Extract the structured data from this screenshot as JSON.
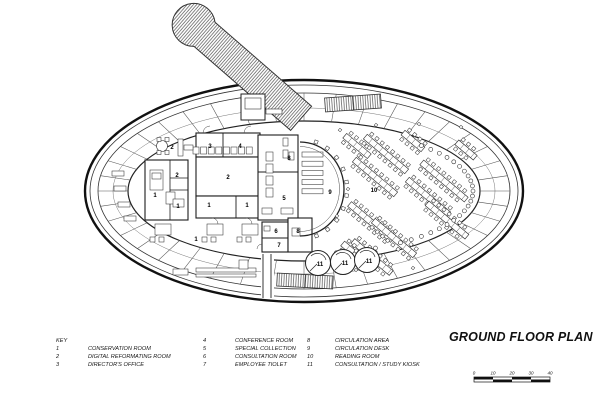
{
  "title": "GROUND FLOOR PLAN",
  "key": {
    "heading": "KEY",
    "items": [
      {
        "num": "1",
        "label": "CONSERVATION ROOM"
      },
      {
        "num": "2",
        "label": "DIGITAL REFORMATING ROOM"
      },
      {
        "num": "3",
        "label": "DIRECTOR'S OFFICE"
      },
      {
        "num": "4",
        "label": "CONFERENCE ROOM"
      },
      {
        "num": "5",
        "label": "SPECIAL COLLECTION"
      },
      {
        "num": "6",
        "label": "CONSULTATION ROOM"
      },
      {
        "num": "7",
        "label": "EMPLOYEE TIOLET"
      },
      {
        "num": "8",
        "label": "CIRCULATION AREA"
      },
      {
        "num": "9",
        "label": "CIRCULATION DESK"
      },
      {
        "num": "10",
        "label": "READING ROOM"
      },
      {
        "num": "11",
        "label": "CONSULTATION / STUDY KIOSK"
      }
    ]
  },
  "scale_bar": {
    "labels": [
      "0",
      "10",
      "20",
      "30",
      "40"
    ]
  },
  "plan": {
    "labels": [
      {
        "t": "1",
        "x": 155,
        "y": 196
      },
      {
        "t": "1",
        "x": 178,
        "y": 207
      },
      {
        "t": "1",
        "x": 209,
        "y": 206
      },
      {
        "t": "1",
        "x": 247,
        "y": 206
      },
      {
        "t": "1",
        "x": 196,
        "y": 240
      },
      {
        "t": "2",
        "x": 172,
        "y": 148
      },
      {
        "t": "2",
        "x": 177,
        "y": 176
      },
      {
        "t": "2",
        "x": 228,
        "y": 178
      },
      {
        "t": "3",
        "x": 210,
        "y": 147
      },
      {
        "t": "4",
        "x": 240,
        "y": 147
      },
      {
        "t": "5",
        "x": 284,
        "y": 199
      },
      {
        "t": "6",
        "x": 276,
        "y": 232
      },
      {
        "t": "7",
        "x": 279,
        "y": 246
      },
      {
        "t": "8",
        "x": 289,
        "y": 159
      },
      {
        "t": "8",
        "x": 298,
        "y": 232
      },
      {
        "t": "9",
        "x": 330,
        "y": 193
      },
      {
        "t": "10",
        "x": 374,
        "y": 191
      },
      {
        "t": "11",
        "x": 320,
        "y": 265
      },
      {
        "t": "11",
        "x": 345,
        "y": 264
      },
      {
        "t": "11",
        "x": 369,
        "y": 262
      }
    ]
  },
  "colors": {
    "ink": "#1a1a1a",
    "paper": "#ffffff"
  }
}
